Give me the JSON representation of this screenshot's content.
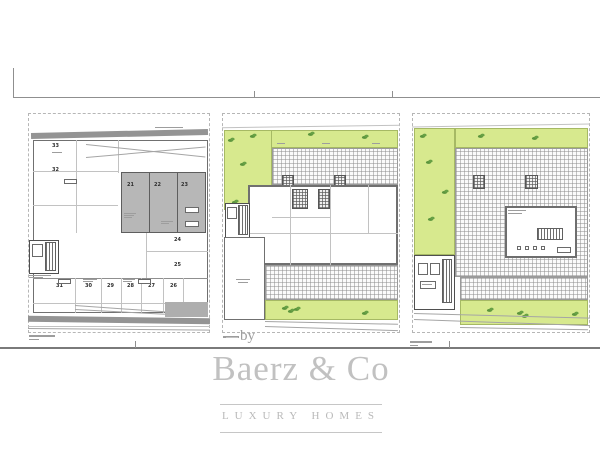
{
  "watermark": {
    "by_label": "by",
    "brand": "Baerz & Co",
    "tagline": "LUXURY HOMES",
    "color": "#c1c1c1"
  },
  "colors": {
    "lawn_green": "#d7e98e",
    "parking_gray": "#b7b7b7",
    "wall_gray": "#949494",
    "line_gray": "#8f8f8f"
  },
  "plan_left": {
    "upper_room_numbers": [
      "33",
      "32"
    ],
    "covered_stall_numbers": [
      "21",
      "22",
      "23"
    ],
    "side_room_numbers": [
      "24",
      "25"
    ],
    "bottom_stall_numbers": [
      "31",
      "30",
      "29",
      "28",
      "27",
      "26"
    ]
  }
}
